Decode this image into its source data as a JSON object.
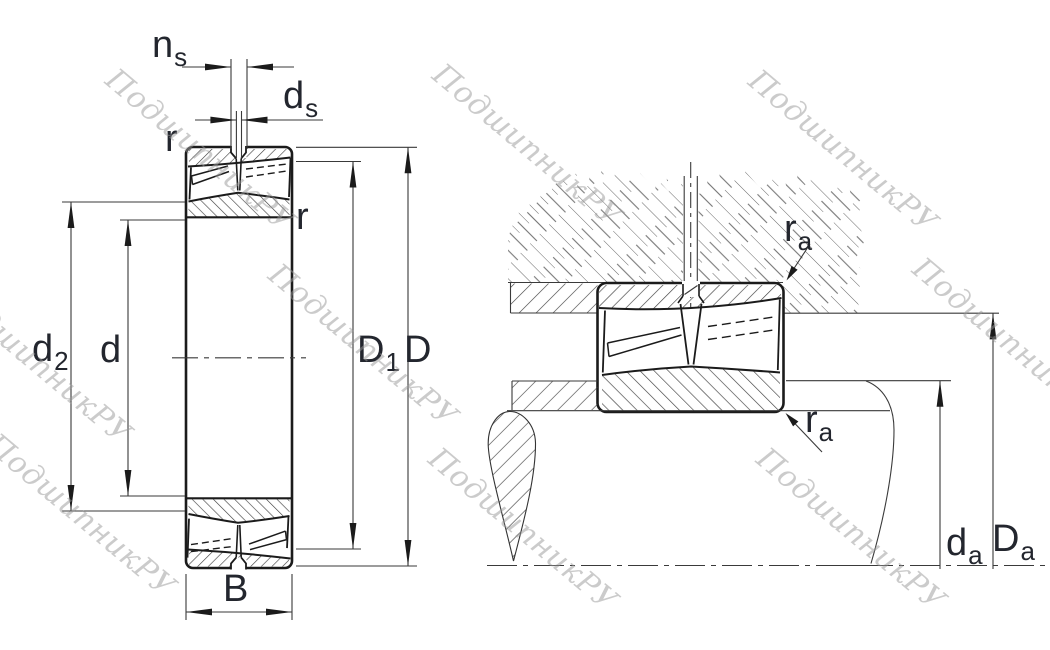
{
  "watermark": {
    "text": "ПодшипникРУ"
  },
  "colors": {
    "background": "#ffffff",
    "line": "#1b1b1b",
    "thin_line": "#3a3a3a",
    "hatch": "#3f3f3f",
    "housing_hatch": "#5a5a5a",
    "label": "#23262e",
    "watermark": "#999999"
  },
  "left_view": {
    "title": "bearing-cross-section",
    "labels": {
      "ns": {
        "base": "n",
        "sub": "s"
      },
      "ds": {
        "base": "d",
        "sub": "s"
      },
      "r_outer": {
        "base": "r",
        "sub": ""
      },
      "r_inner": {
        "base": "r",
        "sub": ""
      },
      "d2": {
        "base": "d",
        "sub": "2"
      },
      "d": {
        "base": "d",
        "sub": ""
      },
      "D1": {
        "base": "D",
        "sub": "1"
      },
      "D": {
        "base": "D",
        "sub": ""
      },
      "B": {
        "base": "B",
        "sub": ""
      }
    }
  },
  "right_view": {
    "title": "mounting-abutment-view",
    "labels": {
      "ra_housing": {
        "base": "r",
        "sub": "a"
      },
      "ra_shaft": {
        "base": "r",
        "sub": "a"
      },
      "da": {
        "base": "d",
        "sub": "a"
      },
      "Da": {
        "base": "D",
        "sub": "a"
      }
    }
  }
}
